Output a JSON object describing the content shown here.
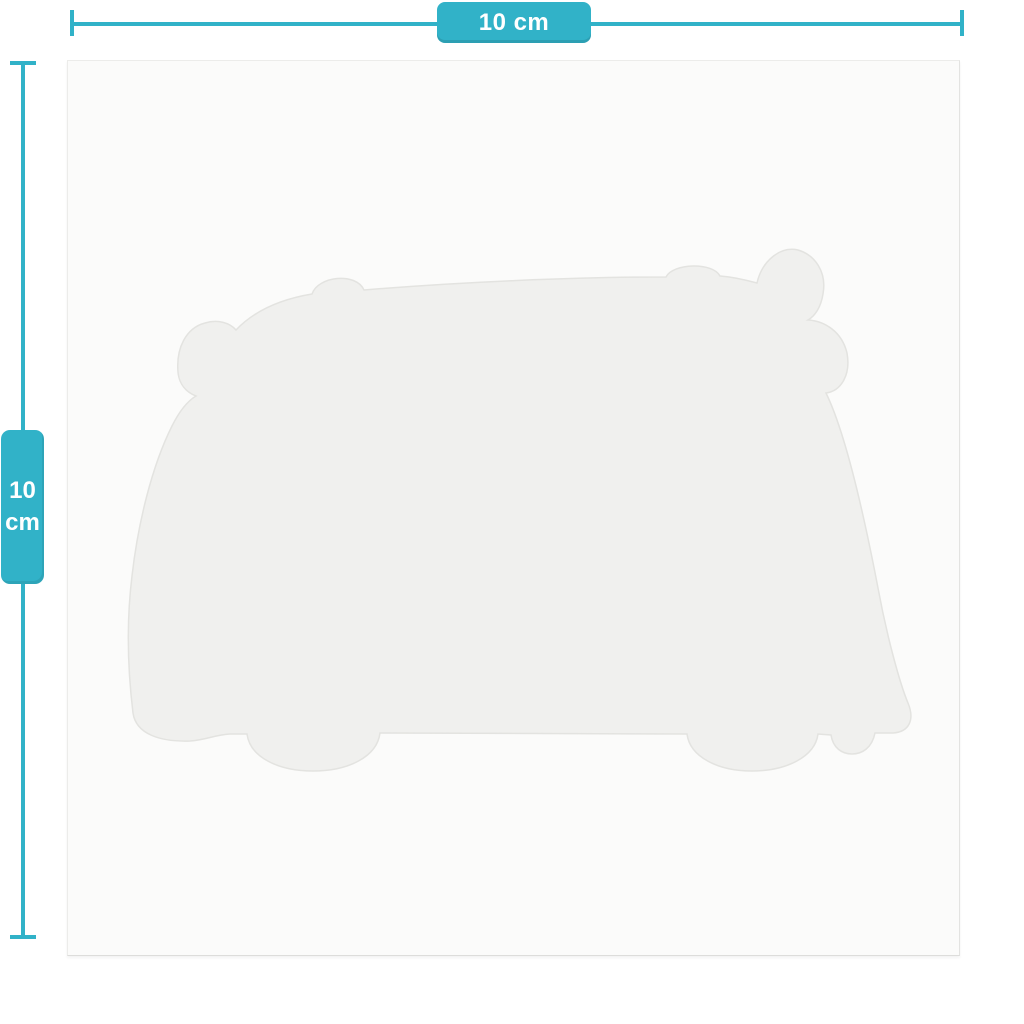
{
  "diagram": {
    "type": "product-dimension-diagram",
    "subject": "camper-van-shaped card silhouette",
    "width_dimension": {
      "label": "10 cm"
    },
    "height_dimension": {
      "value": "10",
      "unit": "cm"
    }
  },
  "colors": {
    "accent_teal": "#31b2c8",
    "accent_teal_shade": "#2aa3ba",
    "page_background": "#ffffff",
    "card_background": "#fbfbfa",
    "card_border": "#ececea",
    "silhouette_fill": "#f0f0ee",
    "silhouette_edge": "#e3e3e0",
    "label_text": "#ffffff"
  }
}
